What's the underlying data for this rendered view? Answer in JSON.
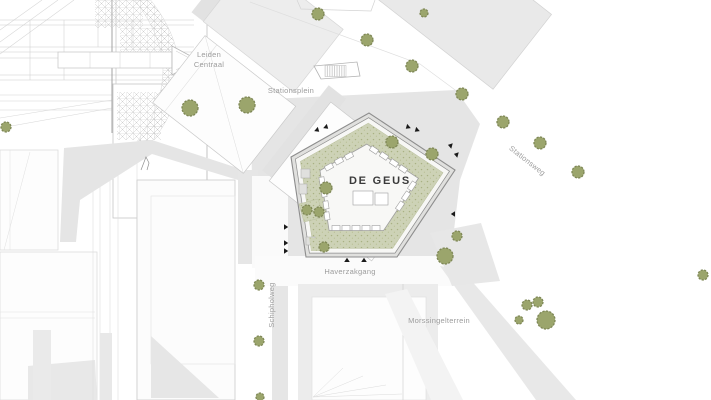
{
  "meta": {
    "drawing_type": "architectural site plan",
    "featured_building": "DE GEUS"
  },
  "labels": {
    "station": "Leiden Centraal",
    "square": "Stationsplein",
    "street_ne": "Stationsweg",
    "alley_s": "Haverzakgang",
    "street_w": "Schipholweg",
    "area_s": "Morssingelterrein",
    "building_name": "DE GEUS"
  },
  "icons": [
    "tree-icon",
    "entrance-arrow-icon"
  ],
  "colors": {
    "background": "#ffffff",
    "plaza_gray": "#e5e5e5",
    "footprint_gray": "#e9e9e9",
    "outline_gray": "#c9c9c9",
    "wall_line": "#8d8d8d",
    "courtyard_green": "#cdd2b6",
    "tree_fill": "#9ba56c",
    "tree_stroke": "#7e8756",
    "street_label": "#9c9c9c",
    "building_label": "#3a3a3a",
    "arrow": "#1a1a1a"
  }
}
